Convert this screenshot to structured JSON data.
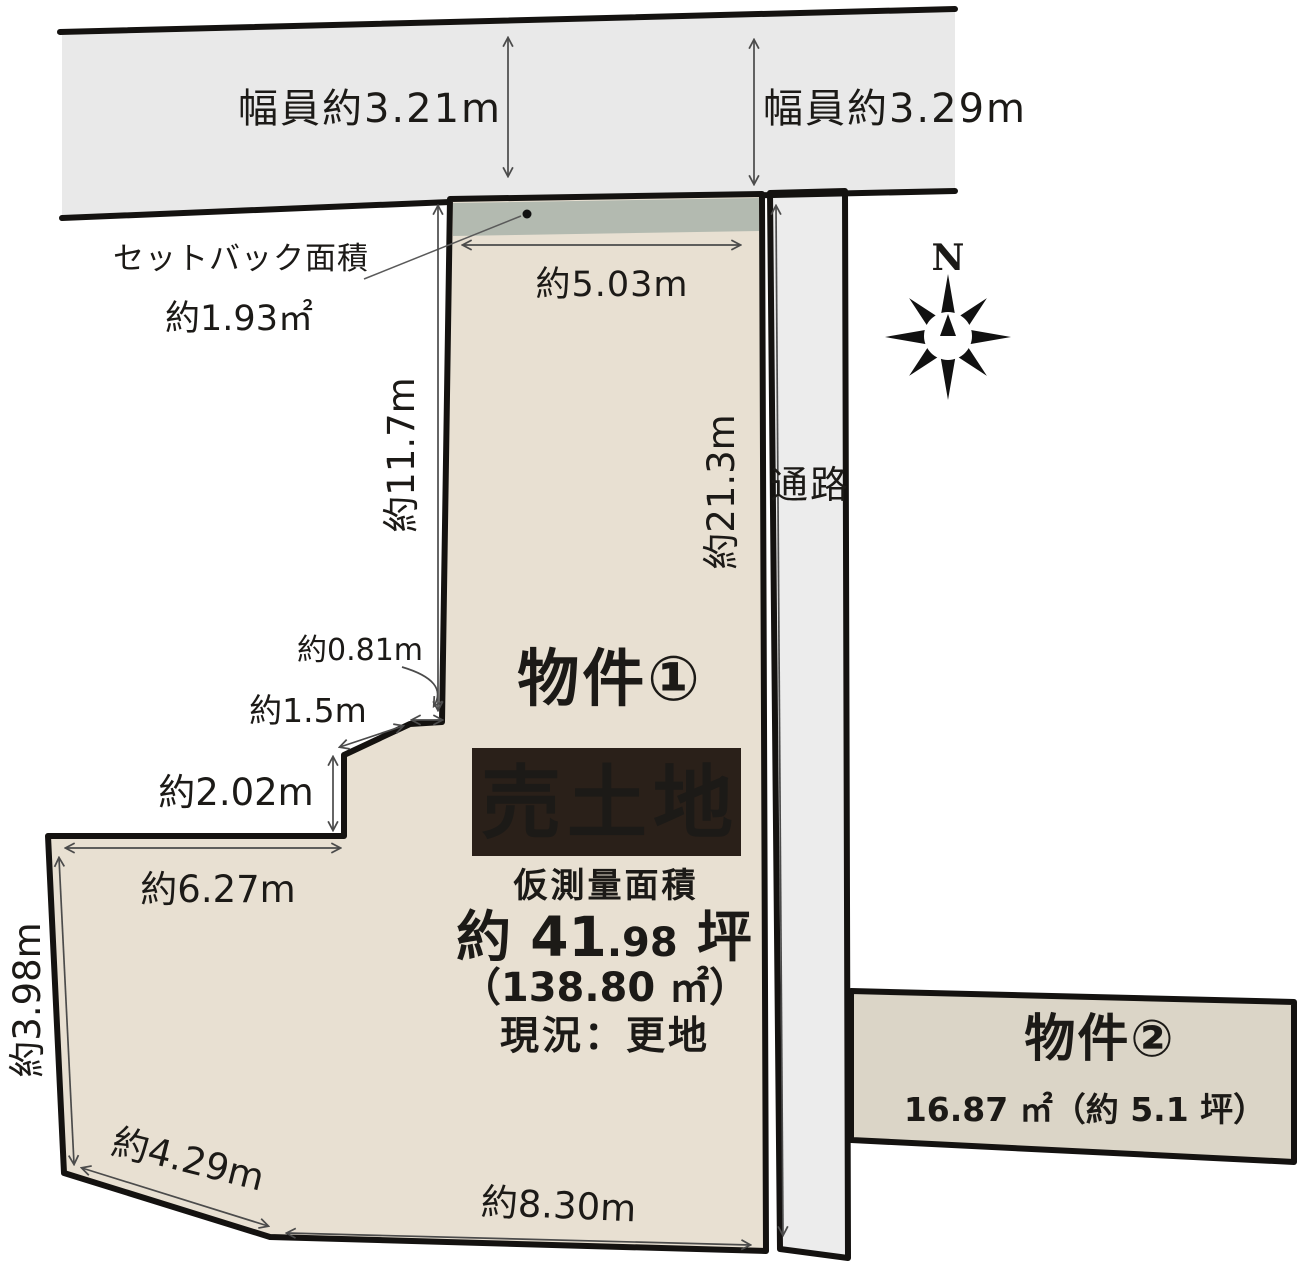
{
  "colors": {
    "bg": "#ffffff",
    "ink": "#1c1a17",
    "road_fill": "#e9e9e9",
    "parcel_fill": "#e8e0d2",
    "setback_fill": "#b3bab0",
    "corridor_fill": "#ececec",
    "p2_fill": "#dbd5c7",
    "badge_bg": "#2a2019",
    "badge_text": "#ffffff",
    "dim_line": "#4b4b4b"
  },
  "road": {
    "width_left": "幅員約3.21m",
    "width_right": "幅員約3.29m"
  },
  "setback": {
    "label": "セットバック面積",
    "area": "約1.93㎡"
  },
  "passage": {
    "label": "通路"
  },
  "compass": {
    "north": "N"
  },
  "property1": {
    "name": "物件①",
    "badge": "売土地",
    "survey_caption": "仮測量面積",
    "tsubo_main": "約 41",
    "tsubo_decimal": ".98",
    "tsubo_unit": " 坪",
    "area_m2": "（138.80 ㎡）",
    "status": "現況：更地"
  },
  "property2": {
    "name": "物件②",
    "area": "16.87 ㎡（約 5.1 坪）"
  },
  "dims": {
    "top": "約5.03m",
    "upper_left": "約11.7m",
    "right": "約21.3m",
    "notch_width": "約0.81m",
    "notch_diagonal": "約1.5m",
    "notch_height": "約2.02m",
    "middle_top": "約6.27m",
    "lower_left": "約3.98m",
    "lower_diagonal": "約4.29m",
    "bottom": "約8.30m"
  }
}
